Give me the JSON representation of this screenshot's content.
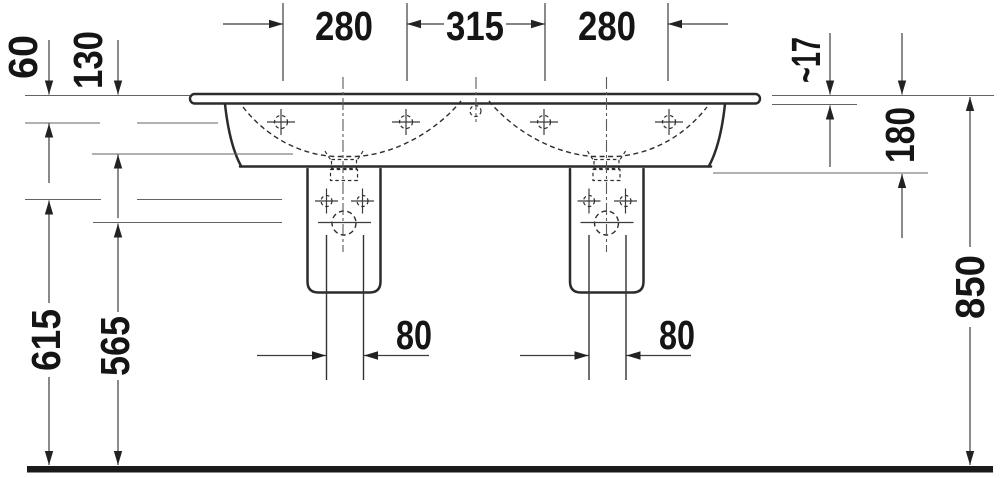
{
  "drawing_type": "technical dimension drawing — double washbasin, front elevation",
  "dims": {
    "top_left": "280",
    "top_center": "315",
    "top_right": "280",
    "left_small": "60",
    "left_medium": "130",
    "left_tall_outer": "615",
    "left_tall_inner": "565",
    "right_small": "~17",
    "right_medium": "180",
    "right_tall": "850",
    "outlet_left": "80",
    "outlet_right": "80"
  },
  "colors": {
    "background": "#ffffff",
    "object_line": "#2b2b2b",
    "reference_line": "#636363",
    "dimension_line": "#3c3c3c",
    "text": "#151515",
    "ground": "#1a1a1a"
  }
}
